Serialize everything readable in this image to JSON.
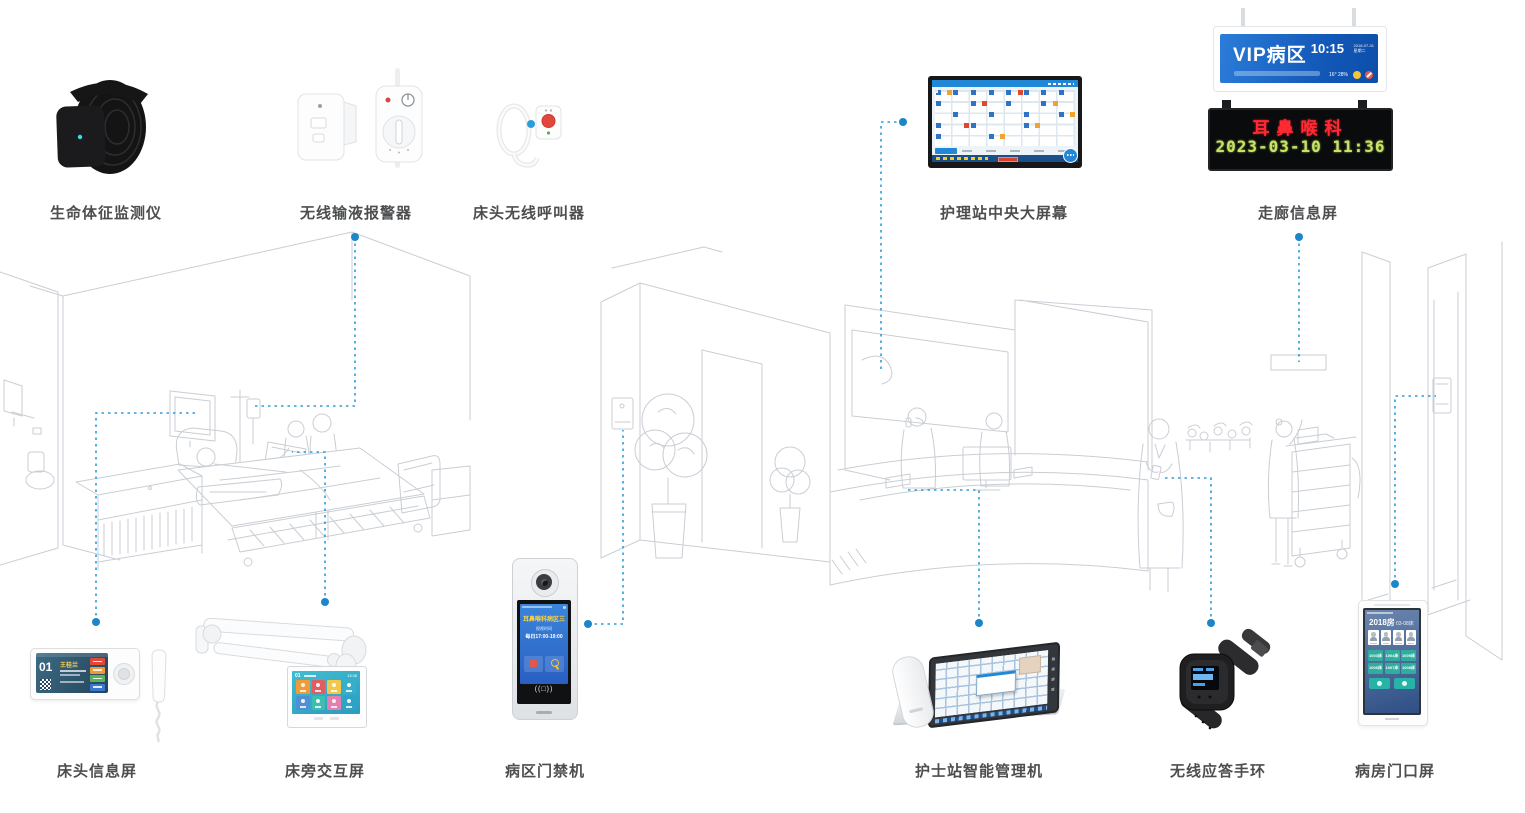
{
  "labels": {
    "vital_monitor": "生命体征监测仪",
    "infusion_alarm": "无线输液报警器",
    "bedside_caller": "床头无线呼叫器",
    "central_screen": "护理站中央大屏幕",
    "corridor_screen": "走廊信息屏",
    "bedside_info_screen": "床头信息屏",
    "bedside_interactive_screen": "床旁交互屏",
    "ward_access_machine": "病区门禁机",
    "nurse_station_console": "护士站智能管理机",
    "wireless_wristband": "无线应答手环",
    "ward_door_screen": "病房门口屏"
  },
  "vip_sign": {
    "title": "VIP病区",
    "time": "10:15",
    "date": "2018-07-31",
    "weekday": "星期二",
    "temperature": "16",
    "humidity": "28"
  },
  "corridor_led": {
    "line1": "耳鼻喉科",
    "line2": "2023-03-10 11:36"
  },
  "bedside_info_ui": {
    "bed_number": "01",
    "patient_name": "王桂兰"
  },
  "interactive_ui": {
    "bed_number": "01",
    "time": "13:36"
  },
  "access_ui": {
    "title": "耳鼻喉科病区三",
    "visit_label": "探视时间",
    "visit_time": "每日17:00-19:00",
    "nfc": "((□))"
  },
  "door_ui": {
    "room": "2018房",
    "bed_range": "03-08床",
    "beds": [
      "1003床",
      "1004床",
      "1005床",
      "1006床",
      "1007床",
      "1008床"
    ]
  },
  "colors": {
    "connector": "#2D9CDB",
    "accent_blue": "#2188D8",
    "led_red": "#FF2A33",
    "led_green": "#C9E465",
    "sketch": "#C9CED4"
  }
}
